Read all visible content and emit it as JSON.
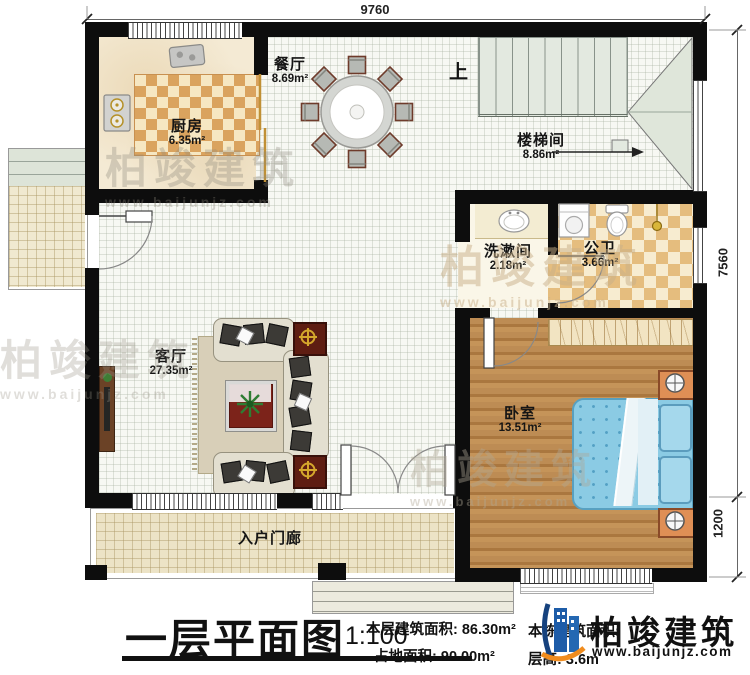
{
  "plan": {
    "stairs_up": "上",
    "rooms": [
      {
        "name": "厨房",
        "area": "6.35m²"
      },
      {
        "name": "餐厅",
        "area": "8.69m²"
      },
      {
        "name": "楼梯间",
        "area": "8.86m²"
      },
      {
        "name": "洗漱间",
        "area": "2.18m²"
      },
      {
        "name": "公卫",
        "area": "3.66m²"
      },
      {
        "name": "客厅",
        "area": "27.35m²"
      },
      {
        "name": "卧室",
        "area": "13.51m²"
      },
      {
        "name": "入户门廊",
        "area": ""
      }
    ],
    "dimensions": {
      "top": "9760",
      "right_upper": "7560",
      "right_lower": "1200"
    }
  },
  "titleblock": {
    "title": "一层平面图",
    "scale": "1:100",
    "stats": [
      {
        "label": "本层建筑面积:",
        "value": "86.30m²"
      },
      {
        "label": "占地面积:",
        "value": "90.00m²"
      },
      {
        "label": "本栋建筑面积:",
        "value": ""
      },
      {
        "label": "层高:",
        "value": "3.6m"
      }
    ],
    "logo": {
      "name": "柏竣建筑",
      "url": "www.baijunjz.com"
    }
  },
  "watermark": {
    "text": "柏竣建筑",
    "url": "www.baijunjz.com"
  }
}
